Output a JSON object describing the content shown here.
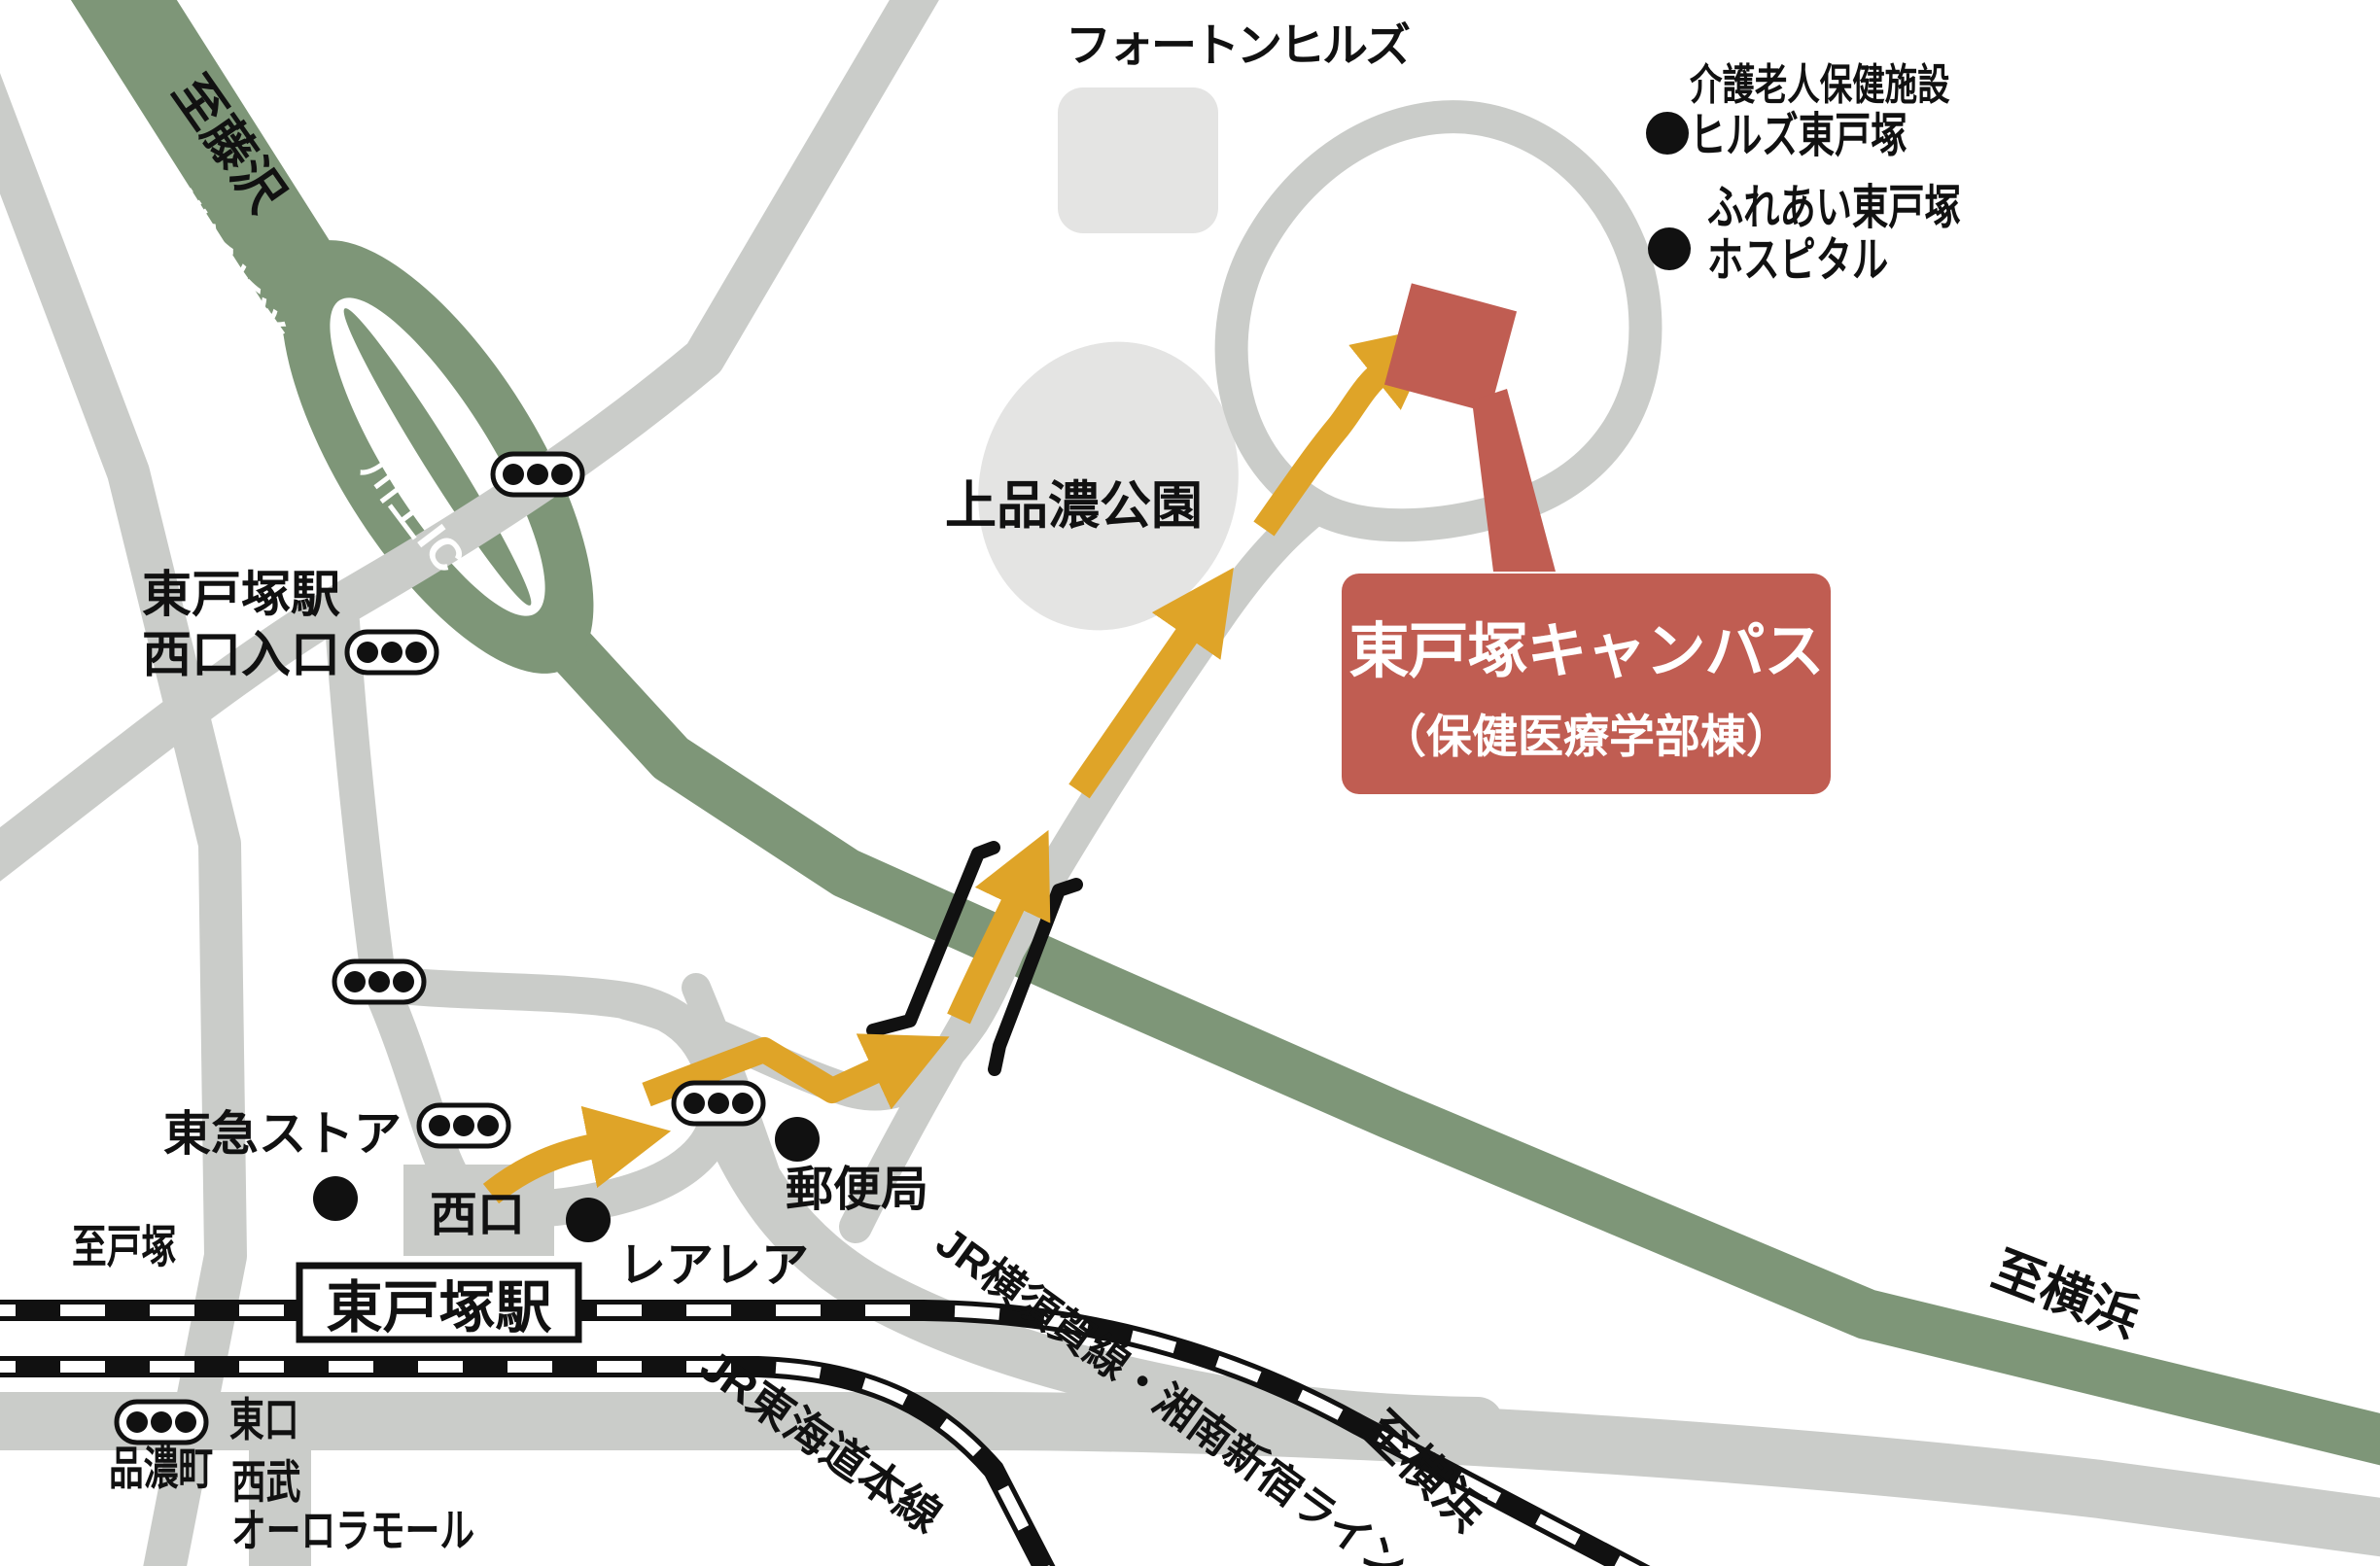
{
  "map": {
    "destination_box": {
      "title": "東戸塚キャンパス",
      "subtitle": "（保健医療学部棟）"
    },
    "roads": {
      "expressway": "横浜新道",
      "interchange": "川上IC"
    },
    "to": {
      "fujisawa": "至藤沢",
      "totsuka": "至戸塚",
      "yokohama_rail": "至横浜",
      "yokohama_road": "至横浜"
    },
    "station": {
      "name": "東戸塚駅",
      "west_entrance_line1": "東戸塚駅",
      "west_entrance_line2": "西口入口",
      "west_gate": "西口",
      "east_gate": "東口"
    },
    "rail": {
      "yokosuka_shonan": "JR横須賀線・湘南新宿ライン",
      "tokaido": "JR東海道本線"
    },
    "places": {
      "photon_hills": "フォートンヒルズ",
      "elder_facility_line1": "介護老人保健施設",
      "elder_facility_line2": "ヒルズ東戸塚",
      "hospital_line1": "ふれあい東戸塚",
      "hospital_line2": "ホスピタル",
      "park": "上品濃公園",
      "tokyu_store": "東急ストア",
      "rearea": "レアレア",
      "post_office": "郵便局",
      "shinano_town": "品濃町",
      "seibu_line1": "西武",
      "seibu_line2": "オーロラモール"
    },
    "colors": {
      "expressway_green": "#7E9678",
      "road_gray": "#CACCC9",
      "block_gray": "#E4E4E3",
      "route_orange": "#DFA428",
      "campus_red": "#C05D52",
      "rail_black": "#111111"
    }
  }
}
